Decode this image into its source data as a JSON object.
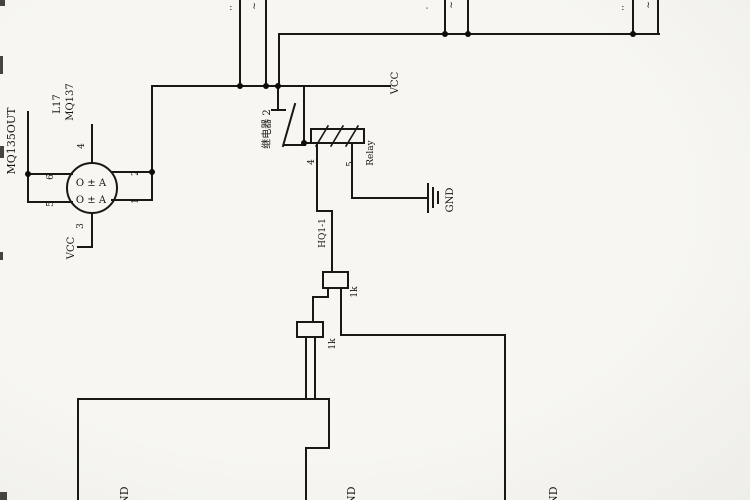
{
  "page": {
    "background": "#f5f4f1",
    "ink": "#1f1d1a",
    "orientation_note": "scanned schematic rotated 90deg CCW"
  },
  "sensor": {
    "net_label": "MQ135OUT",
    "refdes": "L17",
    "part": "MQ137",
    "inner_top": "O ± A",
    "inner_bottom": "O ± A",
    "pin_top": "4",
    "pin_bottom": "3",
    "pin_left_top": "6",
    "pin_left_bottom": "5",
    "pin_right_top": "2",
    "pin_right_bottom": "1",
    "vcc_label": "VCC"
  },
  "relay": {
    "cn_label": "继电器 2",
    "name_label": "Relay",
    "pin_left": "4",
    "pin_right": "5",
    "vcc_label": "VCC",
    "gnd_label": "GND"
  },
  "driver": {
    "wire_label": "HQ1-1",
    "r1_label": "1k",
    "r2_label": "1k"
  },
  "grounds": {
    "bottom_left": "GND",
    "bottom_mid": "GND",
    "bottom_right": "GND"
  },
  "fragments": {
    "f1": "··",
    "f2": "~",
    "f3": "·",
    "f4": "~",
    "f5": "··",
    "f6": "~"
  }
}
